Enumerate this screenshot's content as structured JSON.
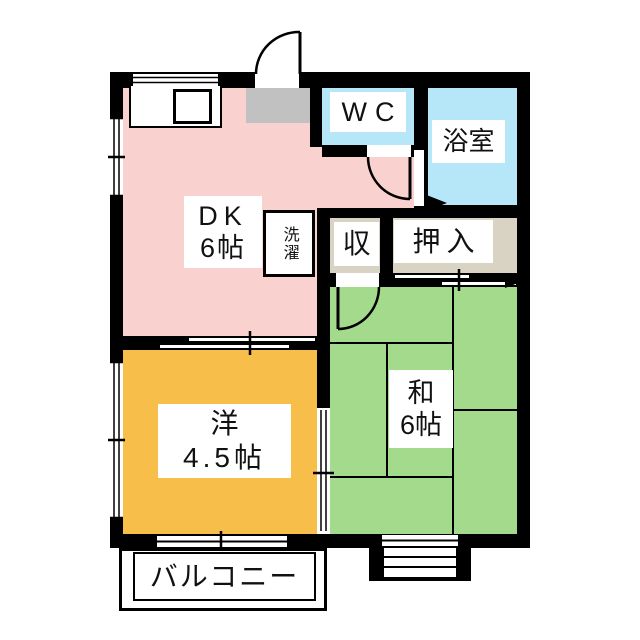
{
  "floorplan": {
    "type": "apartment-floor-plan",
    "background": "#ffffff",
    "wall_color": "#000000",
    "rooms": {
      "dk": {
        "name_line1": "DK",
        "name_line2": "6帖",
        "color": "#f9d1cf"
      },
      "wc": {
        "name": "WC",
        "color": "#b5e7f8"
      },
      "bathroom": {
        "name": "浴室",
        "color": "#b5e7f8"
      },
      "storage": {
        "name": "収",
        "color": "#d9d3c4"
      },
      "closet": {
        "name": "押入",
        "color": "#d9d3c4"
      },
      "japanese_room": {
        "name_line1": "和",
        "name_line2": "6帖",
        "color": "#a3da8b"
      },
      "western_room": {
        "name_line1": "洋",
        "name_line2": "4.5帖",
        "color": "#f8be4a"
      },
      "balcony": {
        "name": "バルコニー",
        "color": "#ffffff"
      },
      "laundry": {
        "name": "洗濯",
        "color": "#ffffff"
      },
      "entrance": {
        "color": "#c1c1c1"
      }
    }
  }
}
